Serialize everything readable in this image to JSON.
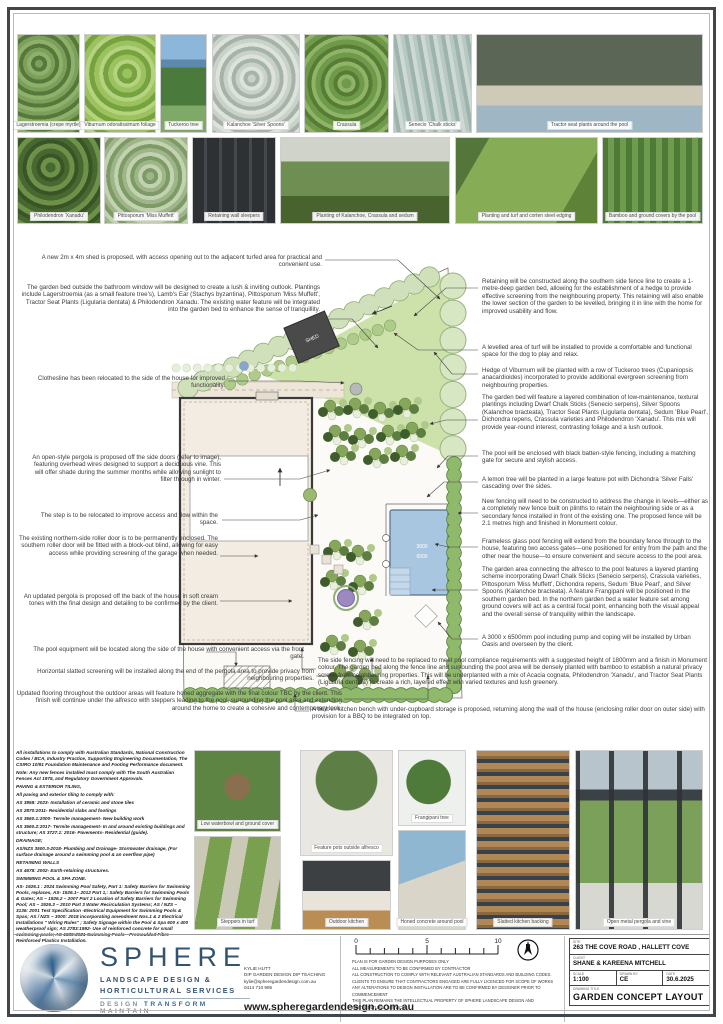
{
  "photos_top": [
    "Lagerstroemia (crepe myrtle)",
    "Viburnum odoratissimum foliage",
    "Tuckeroo tree",
    "Kalanchoe 'Silver Spoons'",
    "Crassula",
    "Senecio 'Chalk sticks'",
    "Tractor seat plants around the pool"
  ],
  "photos_mid": [
    "Philodendron 'Xanadu'",
    "Pittosporum 'Miss Muffett'",
    "Retaining wall sleepers",
    "Planting of Kalanchoe, Crassula and sedum",
    "Planting and turf and corten steel edging",
    "Bamboo and ground covers by the pool"
  ],
  "photos_bottom": [
    "Low waterbowl and ground cover",
    "Steppers in turf",
    "Feature pots outside alfresco",
    "Outdoor kitchen",
    "Frangipani tree",
    "Honed concrete around pool",
    "Slatted kitchen backing",
    "Open metal pergola and vine"
  ],
  "annotations": {
    "left": [
      "A new 2m x 4m shed is proposed, with access opening out to the adjacent turfed area for practical and convenient use.",
      "The garden bed outside the bathroom window will be designed to create a lush & inviting outlook. Plantings include Lagerstroemia (as a small feature tree's), Lamb's Ear (Stachys byzantina), Pittosporum 'Miss Muffett', Tractor Seat Plants (Ligularia dentata) & Philodendron Xanadu. The existing water feature will be integrated into the garden bed to enhance the sense of tranquillity.",
      "Clothesline has been relocated to the side of the house for improved functionality.",
      "An open-style pergola is proposed off the side doors (refer to image), featuring overhead wires designed to support a deciduous vine. This will offer shade during the summer months while allowing sunlight to filter through in winter.",
      "The step is to be relocated to improve access and flow within the space.",
      "The existing northern-side roller door is to be permanently enclosed. The southern roller door will be fitted with a block-out blind, allowing for easy access while providing screening of the garage when needed.",
      "An updated pergola is proposed off the back of the house in soft cream tones with the final design and detailing to be confirmed by the client.",
      "The pool equipment will be located along the side of the house with convenient access via the front gate.",
      "Horizontal slatted screening will be installed along the end of the pergola area to provide privacy from neighbouring properties.",
      "Updated flooring throughout the outdoor areas will feature honed aggregate with the final colour TBC by the client. This finish will continue under the alfresco with steppers leading to the pool, surrounding the pool area and extending around the home to create a cohesive and contemporary look."
    ],
    "right": [
      "Retaining will be constructed along the southern side fence line to create a 1-metre-deep garden bed, allowing for the establishment of a hedge to provide effective screening from the neighbouring property. This retaining will also enable the lower section of the garden to be levelled, bringing it in line with the home for improved usability and flow.",
      "A levelled area of turf will be installed to provide a comfortable and functional space for the dog to play and relax.",
      "Hedge of Viburnum will be planted with a row of Tuckeroo trees (Cupaniopsis anacardioides) incorporated to provide additional evergreen screening from neighbouring properties.",
      "The garden bed will feature a layered combination of low-maintenance, textural plantings including Dwarf Chalk Sticks (Senecio serpens), Silver Spoons (Kalanchoe bracteata), Tractor Seat Plants (Ligularia dentata), Sedum 'Blue Pearl', Dichondra repens, Crassula varieties and Philodendron 'Xanadu'. This mix will provide year-round interest, contrasting foliage and a lush outlook.",
      "The pool will be enclosed with black batten-style fencing, including a matching gate for secure and stylish access.",
      "A lemon tree will be planted in a large feature pot with Dichondra 'Silver Falls' cascading over the sides.",
      "New fencing will need to be constructed to address the change in levels—either as a completely new fence built on plinths to retain the neighbouring side or as a secondary fence installed in front of the existing one. The proposed fence will be 2.1 metres high and finished in Monument colour.",
      "Frameless glass pool fencing will extend from the boundary fence through to the house, featuring two access gates—one positioned for entry from the path and the other near the house—to ensure convenient and secure access to the pool area.",
      "The garden area connecting the alfresco to the pool features a layered planting scheme incorporating Dwarf Chalk Sticks (Senecio serpens), Crassula varieties, Pittosporum 'Miss Muffett', Dichondra repens, Sedum 'Blue Pearl', and Silver Spoons (Kalanchoe bracteata). A feature Frangipani will be positioned in the southern garden bed. In the northern garden bed a water feature set among ground covers will act as a central focal point, enhancing both the visual appeal and the overall sense of tranquility within the landscape.",
      "A 3000 x 6500mm pool including pump and coping will be installed by Urban Oasis and overseen by the client."
    ],
    "bottom": [
      "The side fencing will need to be replaced to meet pool compliance requirements with a suggested height of 1800mm and a finish in Monument colour. The garden bed along the fence line and surrounding the pool area will be densely planted with bamboo to establish a natural privacy screen from neighbouring properties. This will be underplanted with a mix of Acacia cognata, Philodendron 'Xanadu', and Tractor Seat Plants (Ligularia dentata) to create a rich, layered effect with varied textures and lush greenery.",
      "A built-in kitchen bench with under-cupboard storage is proposed, returning along the wall of the house (enclosing roller door on outer side) with provision for a BBQ to be integrated on top."
    ]
  },
  "plan": {
    "shed_label": "SHED",
    "pool_width_label": "3000",
    "pool_length_label": "6500"
  },
  "compliance": {
    "lines": [
      "All installations to comply with Australian Standards, National Construction Codes / BCA, Industry Practice, Supporting Engineering Documentation, The CSIRO 10/91 Foundation Maintenance and Footing Performance document.",
      "Note: Any new fences installed must comply with The South Australian Fences Act 1975, and Regulatory Government Approvals.",
      "PAVING & EXTERIOR TILING,",
      "All paving and exterior tiling to comply with:",
      "AS 3958: 2023- Installation of ceramic and stone tiles",
      "AS 2870:2011- Residential slabs and footings",
      "AS 3660.1:2000- Termite management- New building work",
      "AS 3660.2:2017- Termite management- In and around existing buildings and structure; AS 3727.1: 2016- Pavements- Residential (guide).",
      "DRAINAGE;",
      "AS/NZS 3500.3-2018- Plumbing and Drainage- Stormwater drainage, (For surface drainage around a swimming pool & an overflow pipe)",
      "RETAINING WALLS",
      "AS 4678: 2002- Earth-retaining structures.",
      "SWIMMING POOL & SPA ZONE.",
      "AS- 1926.1 : 2024 Swimming Pool Safety, Part 1: Safety Barriers for Swimming Pools, replaces, AS- 1926.1– 2012 Part 1,: Safety Barriers for Swimming Pools & Gates; AS – 1926.2 – 2007 Part 2 Location of Safety Barriers for Swimming Pool; AS – 1926.3 – 2010 Part 3 Water Recirculation Systems; AS / NZS – 3136: 2001 Test Specification -Electrical Equipment for Swimming Pools & Spas; AS / NZS – 3000: 2018 incorporating amendment Nos.1 & 2 Electrical Installations \" Wiring Rules\" ; Safety Signage within the Pool & Spa 600 x 400 weatherproof sign; AS 2783:1992- Use of reinforced concrete for small swimming pools; AS 1839:2021 Swimming Pools—Premoulded Fibre—Reinforced Plastics Installation."
    ]
  },
  "footer": {
    "brand": {
      "name": "SPHERE",
      "line1": "LANDSCAPE DESIGN &",
      "line2": "HORTICULTURAL SERVICES",
      "tagline_1": "DESIGN",
      "tagline_2": "TRANSFORM",
      "tagline_3": "MAINTAIN"
    },
    "contact": {
      "name": "KYLIE HUTT",
      "qualification": "DIP GARDEN DESIGN DIP TEACHING",
      "email": "kylie@spheregardendesign.com.au",
      "phone": "0414 710 985"
    },
    "website": "www.spheregardendesign.com.au",
    "scale_ticks": [
      "0",
      "5",
      "10"
    ],
    "notes": [
      "PLAN IS FOR GARDEN DESIGN PURPOSES ONLY",
      "ALL MEASUREMENTS TO BE CONFIRMED BY CONTRACTOR",
      "ALL CONSTRUCTION TO COMPLY WITH RELEVANT AUSTRALIAN STANDARDS AND BUILDING CODES.",
      "CLIENTS TO ENSURE THAT CONTRACTORS ENGAGED ARE FULLY LICENCED FOR SCOPE OF WORKS",
      "ANY ALTERATIONS TO DESIGN INSTALLATION ARE TO BE CONFIRMED BY DESIGNER PRIOR TO COMMENCEMENT",
      "THIS PLAN REMAINS THE INTELLECTUAL PROPERTY OF SPHERE LANDSCAPE DESIGN AND HORTICULTURAL SERVICES"
    ],
    "title_block": {
      "site_label": "SITE",
      "site_value": "263 THE COVE ROAD , HALLETT COVE",
      "client_label": "CLIENT",
      "client_value": "SHANE & KAREENA MITCHELL",
      "scale_label": "SCALE",
      "scale_value": "1:100",
      "drawn_label": "DRAWN BY",
      "drawn_value": "CE",
      "date_label": "DATE",
      "date_value": "30.6.2025",
      "drawing_title_label": "DRAWING TITLE",
      "drawing_title_value": "GARDEN CONCEPT LAYOUT"
    }
  }
}
